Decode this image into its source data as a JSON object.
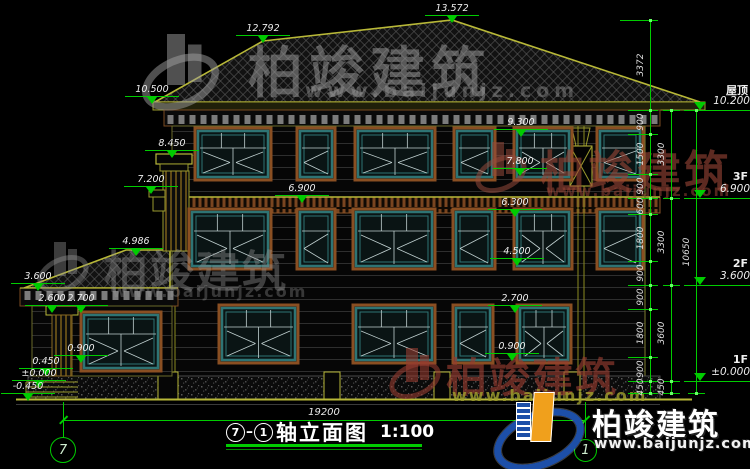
{
  "drawing_title": {
    "axis_start": "7",
    "axis_end": "1",
    "title_text": "轴立面图",
    "scale": "1:100"
  },
  "overall_dimension": "19200",
  "axis_bubbles": [
    {
      "label": "7"
    },
    {
      "label": "1"
    }
  ],
  "elevation_markers": [
    {
      "value": "13.572",
      "x": 452,
      "y": 4
    },
    {
      "value": "12.792",
      "x": 263,
      "y": 24
    },
    {
      "value": "10.500",
      "x": 152,
      "y": 85
    },
    {
      "value": "9.300",
      "x": 521,
      "y": 118
    },
    {
      "value": "8.450",
      "x": 172,
      "y": 139
    },
    {
      "value": "7.800",
      "x": 520,
      "y": 157
    },
    {
      "value": "7.200",
      "x": 151,
      "y": 175
    },
    {
      "value": "6.900",
      "x": 302,
      "y": 184
    },
    {
      "value": "6.300",
      "x": 515,
      "y": 198
    },
    {
      "value": "4.986",
      "x": 136,
      "y": 237
    },
    {
      "value": "4.500",
      "x": 517,
      "y": 247
    },
    {
      "value": "3.600",
      "x": 38,
      "y": 272
    },
    {
      "value": "2.600",
      "x": 52,
      "y": 294
    },
    {
      "value": "2.700",
      "x": 81,
      "y": 294
    },
    {
      "value": "2.700",
      "x": 515,
      "y": 294
    },
    {
      "value": "0.900",
      "x": 81,
      "y": 344
    },
    {
      "value": "0.900",
      "x": 512,
      "y": 342
    },
    {
      "value": "0.450",
      "x": 46,
      "y": 357
    },
    {
      "value": "±0.000",
      "x": 39,
      "y": 369
    },
    {
      "value": "-0.450",
      "x": 28,
      "y": 382
    }
  ],
  "dimensions_right": {
    "col_inner": [
      "3372",
      "900",
      "1500",
      "900",
      "600",
      "1800",
      "900",
      "900",
      "1800",
      "900",
      "450"
    ],
    "col_middle": [
      "3300",
      "3300",
      "3600",
      "450"
    ],
    "col_outer": [
      "10650"
    ]
  },
  "floor_labels": [
    {
      "name": "屋顶",
      "elevation": "10.200"
    },
    {
      "name": "3F",
      "elevation": "6.900"
    },
    {
      "name": "2F",
      "elevation": "3.600"
    },
    {
      "name": "1F",
      "elevation": "±0.000"
    }
  ],
  "watermark": {
    "brand": "柏竣建筑",
    "website": "www.baijunjz.com"
  },
  "colors": {
    "dimension_green": "#00cc00",
    "outline_yellow": "#b8b838",
    "trim_brown": "#8a4f22",
    "window_teal": "#2e7474",
    "logo_blue": "#1d4fa8",
    "logo_orange": "#f0a01c"
  }
}
